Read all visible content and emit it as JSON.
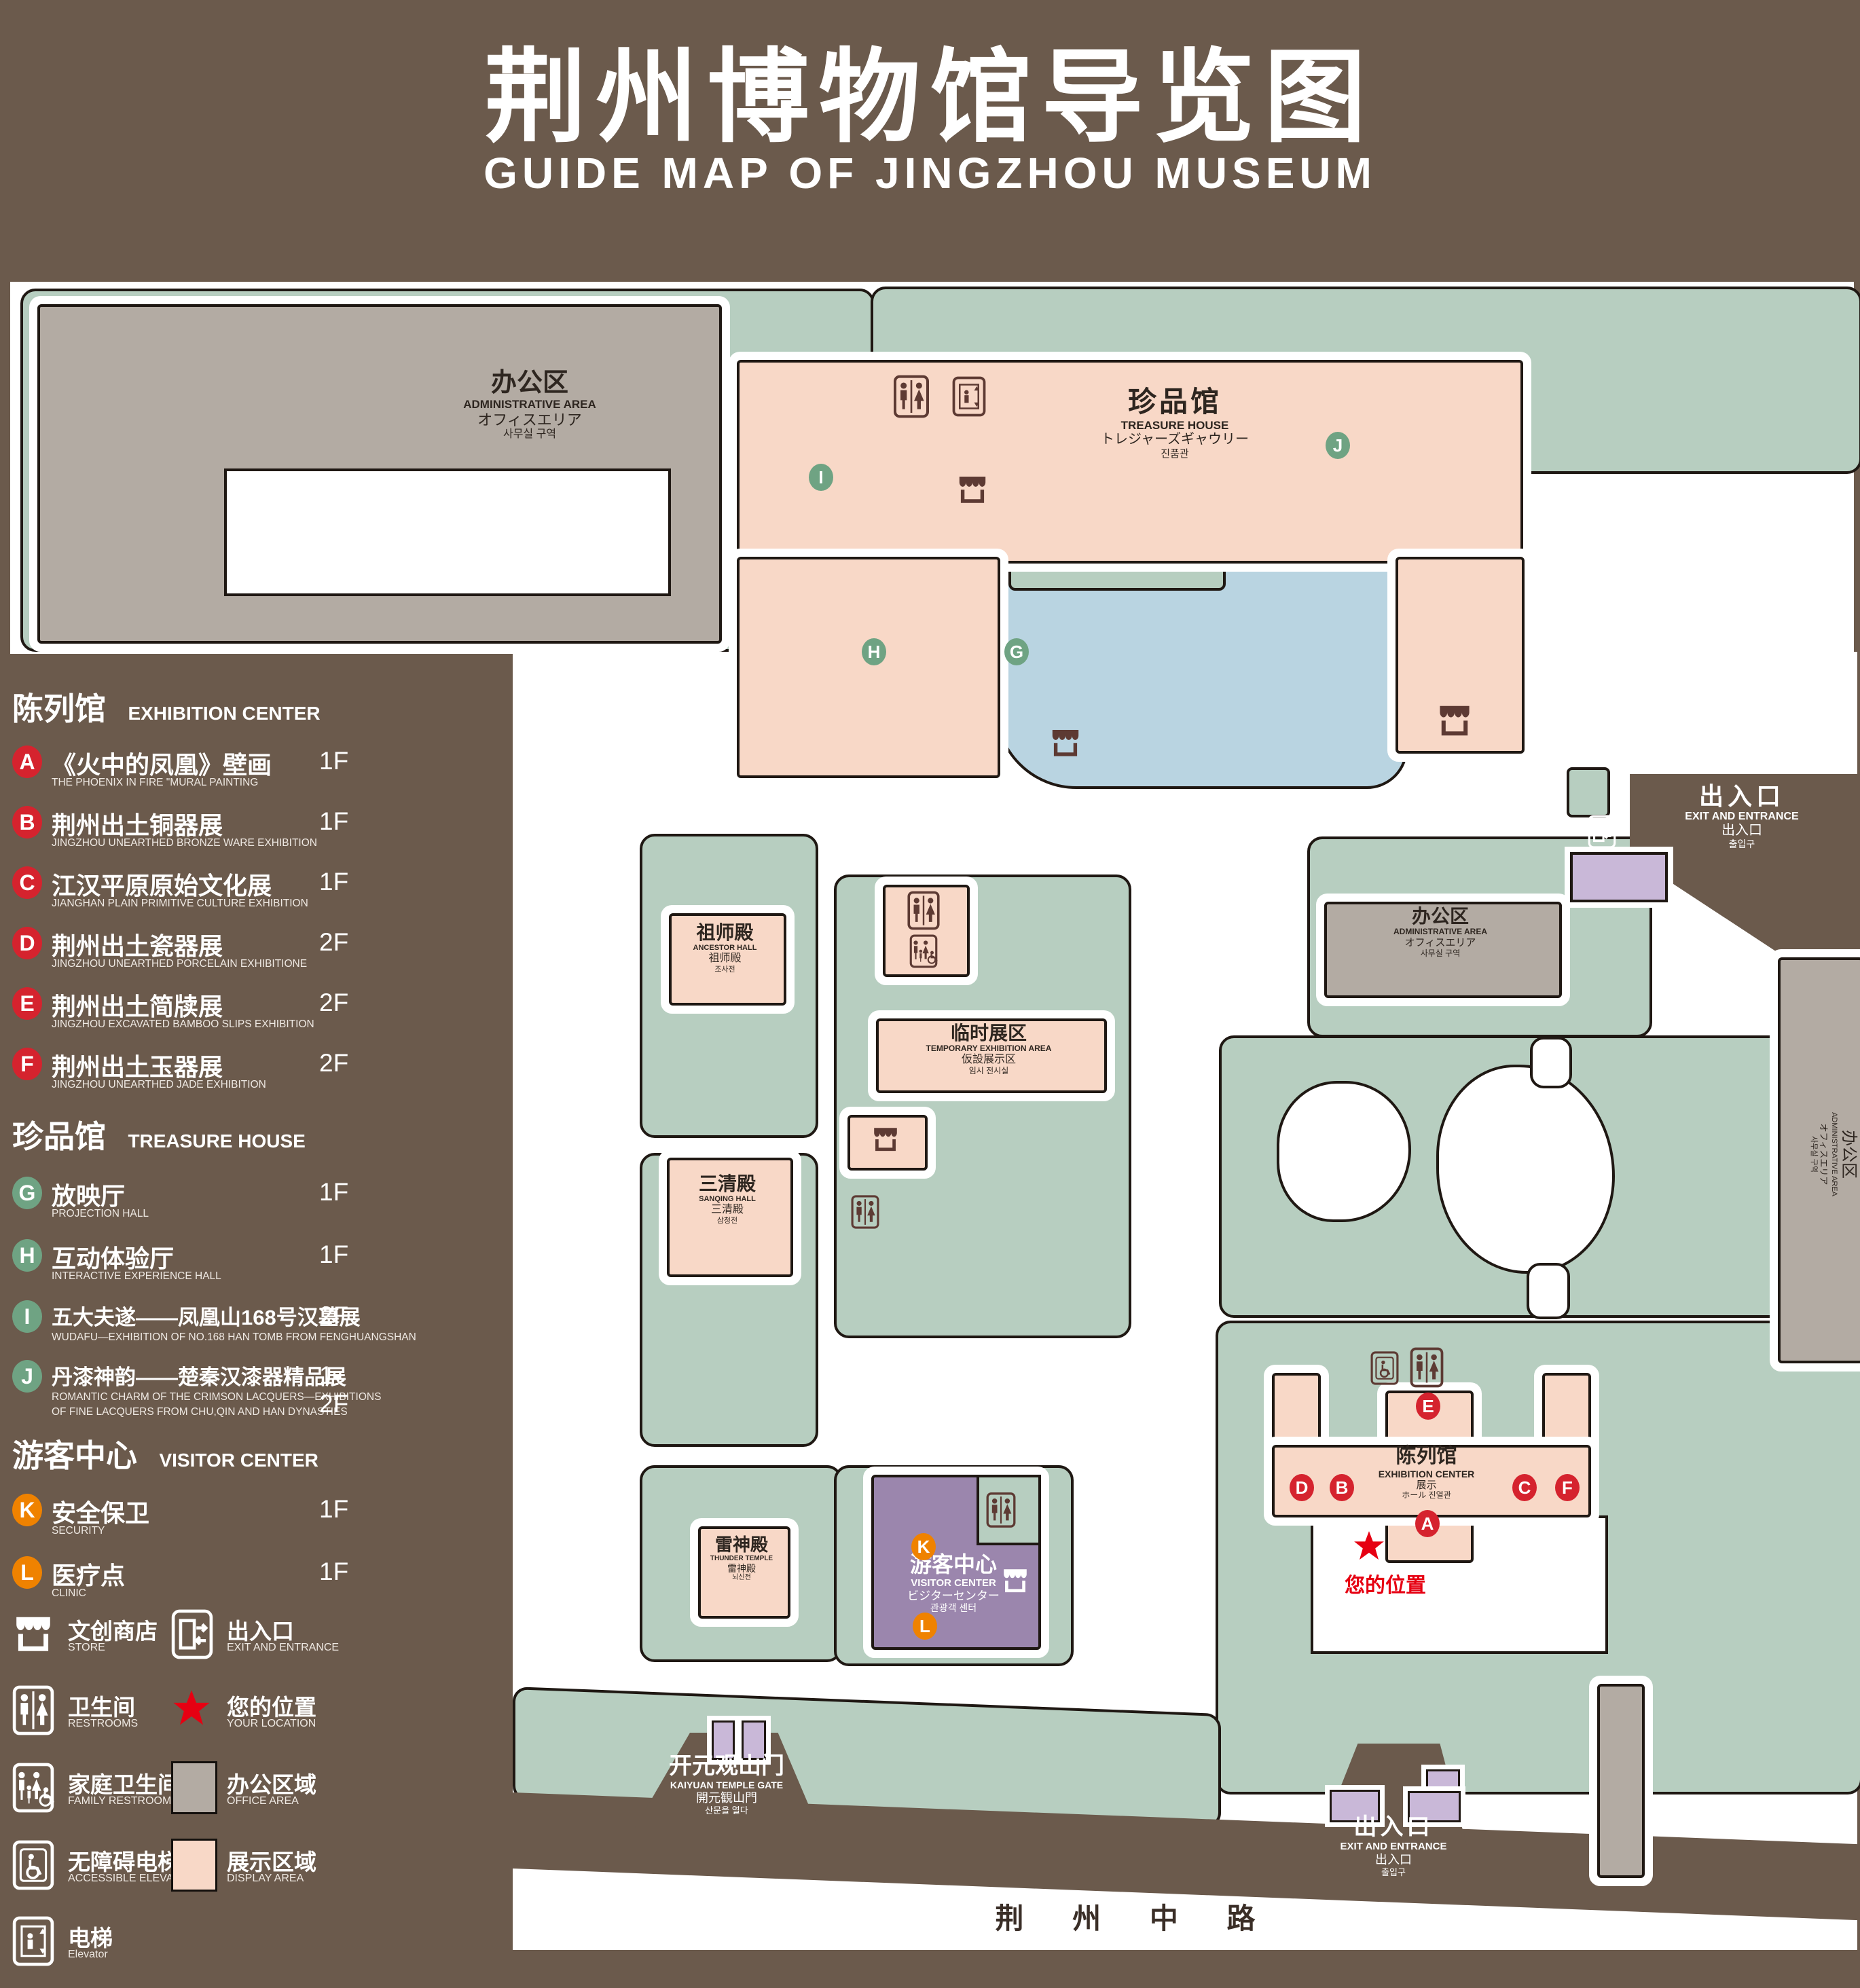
{
  "header": {
    "title_zh": "荆州博物馆导览图",
    "title_en": "GUIDE MAP OF JINGZHOU MUSEUM"
  },
  "legend": {
    "sections": [
      {
        "title_zh": "陈列馆",
        "title_en": "EXHIBITION CENTER",
        "items": [
          {
            "letter": "A",
            "zh": "《火中的凤凰》壁画",
            "en": "THE PHOENIX IN FIRE \"MURAL PAINTING",
            "floor": "1F"
          },
          {
            "letter": "B",
            "zh": "荆州出土铜器展",
            "en": "JINGZHOU UNEARTHED BRONZE WARE EXHIBITION",
            "floor": "1F"
          },
          {
            "letter": "C",
            "zh": "江汉平原原始文化展",
            "en": "JIANGHAN PLAIN PRIMITIVE CULTURE EXHIBITION",
            "floor": "1F"
          },
          {
            "letter": "D",
            "zh": "荆州出土瓷器展",
            "en": "JINGZHOU UNEARTHED PORCELAIN EXHIBITIONE",
            "floor": "2F"
          },
          {
            "letter": "E",
            "zh": "荆州出土简牍展",
            "en": "JINGZHOU EXCAVATED BAMBOO SLIPS EXHIBITION",
            "floor": "2F"
          },
          {
            "letter": "F",
            "zh": "荆州出土玉器展",
            "en": "JINGZHOU UNEARTHED JADE EXHIBITION",
            "floor": "2F"
          }
        ]
      },
      {
        "title_zh": "珍品馆",
        "title_en": "TREASURE HOUSE",
        "items": [
          {
            "letter": "G",
            "zh": "放映厅",
            "en": "PROJECTION HALL",
            "floor": "1F"
          },
          {
            "letter": "H",
            "zh": "互动体验厅",
            "en": "INTERACTIVE EXPERIENCE HALL",
            "floor": "1F"
          },
          {
            "letter": "I",
            "zh": "五大夫遂——凤凰山168号汉墓展",
            "en": "WUDAFU—EXHIBITION OF NO.168 HAN TOMB FROM FENGHUANGSHAN",
            "floor": "2F"
          },
          {
            "letter": "J",
            "zh": "丹漆神韵——楚秦汉漆器精品展",
            "en": "ROMANTIC CHARM OF THE CRIMSON LACQUERS—EXHIBITIONS",
            "en2": "OF FINE LACQUERS FROM CHU,QIN AND HAN DYNASTIES",
            "floor": "1-2F"
          }
        ]
      },
      {
        "title_zh": "游客中心",
        "title_en": "VISITOR CENTER",
        "items": [
          {
            "letter": "K",
            "zh": "安全保卫",
            "en": "SECURITY",
            "floor": "1F"
          },
          {
            "letter": "L",
            "zh": "医疗点",
            "en": "CLINIC",
            "floor": "1F"
          }
        ]
      }
    ],
    "symbols": [
      {
        "icon": "store-icon",
        "zh": "文创商店",
        "en": "STORE"
      },
      {
        "icon": "exit-icon",
        "zh": "出入口",
        "en": "EXIT AND ENTRANCE"
      },
      {
        "icon": "restrooms-icon",
        "zh": "卫生间",
        "en": "RESTROOMS"
      },
      {
        "icon": "your-location-star",
        "zh": "您的位置",
        "en": "YOUR LOCATION"
      },
      {
        "icon": "family-restrooms-icon",
        "zh": "家庭卫生间",
        "en": "FAMILY RESTROOMS"
      },
      {
        "icon": "office-area-swatch",
        "zh": "办公区域",
        "en": "OFFICE AREA"
      },
      {
        "icon": "accessible-elevator-icon",
        "zh": "无障碍电梯",
        "en": "ACCESSIBLE ELEVATOR"
      },
      {
        "icon": "display-area-swatch",
        "zh": "展示区域",
        "en": "DISPLAY AREA"
      },
      {
        "icon": "elevator-icon",
        "zh": "电梯",
        "en": "Elevator"
      }
    ]
  },
  "map": {
    "admin": {
      "zh": "办公区",
      "en": "ADMINISTRATIVE AREA",
      "ja": "オフィスエリア",
      "ko": "사무실 구역"
    },
    "treasure": {
      "zh": "珍品馆",
      "en": "TREASURE HOUSE",
      "ja": "トレジャーズギャウリー",
      "ko": "진품관"
    },
    "ancestor": {
      "zh": "祖师殿",
      "en": "ANCESTOR HALL",
      "ja": "祖师殿",
      "ko": "조사전"
    },
    "temporary": {
      "zh": "临时展区",
      "en": "TEMPORARY EXHIBITION AREA",
      "ja": "仮設展示区",
      "ko": "임시 전시실"
    },
    "sanqing": {
      "zh": "三清殿",
      "en": "SANQING HALL",
      "ja": "三清殿",
      "ko": "삼청전"
    },
    "thunder": {
      "zh": "雷神殿",
      "en": "THUNDER TEMPLE",
      "ja": "雷神殿",
      "ko": "뇌신전"
    },
    "visitor": {
      "zh": "游客中心",
      "en": "VISITOR CENTER",
      "ja": "ビジターセンター",
      "ko": "관광객 센터"
    },
    "exhibition": {
      "zh": "陈列馆",
      "en": "EXHIBITION CENTER",
      "ja1": "展示",
      "ja2": "ホール",
      "ko": "진열관"
    },
    "gate_exit": {
      "zh": "出入口",
      "en": "EXIT AND ENTRANCE",
      "ja": "出入口",
      "ko": "출입구"
    },
    "kaiyuan": {
      "zh": "开元观山门",
      "en": "KAIYUAN TEMPLE GATE",
      "ja": "開元観山門",
      "ko": "산문을 열다"
    },
    "road": "荆 州 中 路",
    "colors": {
      "background": "#6b5a4c",
      "lawn": "#b7cec0",
      "display_area": "#f8d8c7",
      "office_area": "#b3aba3",
      "pond": "#b9d4e1",
      "visitor_center": "#9b86ad",
      "letter_red": "#d5232e",
      "letter_green": "#6fa383",
      "letter_orange": "#ef8200",
      "star_red": "#e60012"
    }
  }
}
